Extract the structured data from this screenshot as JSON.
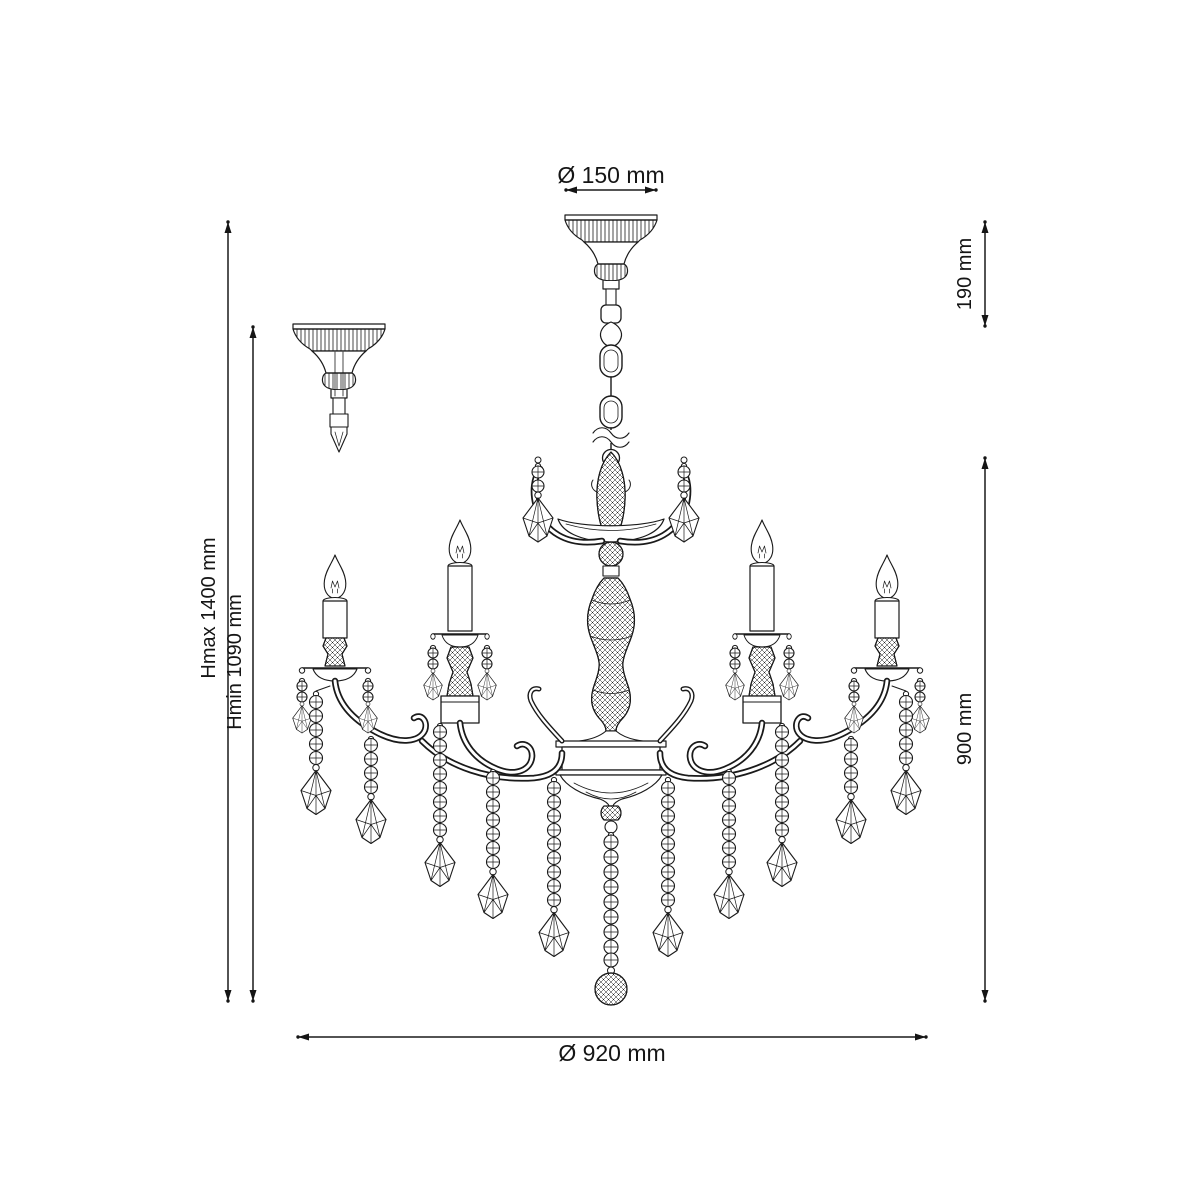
{
  "page": {
    "background_color": "#ffffff",
    "line_color": "#1a1a1a",
    "description": "Technical dimension drawing of a 6-arm crystal chandelier with candle lights, bead strands and faceted pendant drops"
  },
  "diagram": {
    "labels": {
      "top_diameter": "Ø 150 mm",
      "canopy_height": "190 mm",
      "height_max": "Hmax 1400 mm",
      "height_min": "Hmin 1090 mm",
      "body_height": "900 mm",
      "body_diameter": "Ø 920 mm"
    }
  }
}
